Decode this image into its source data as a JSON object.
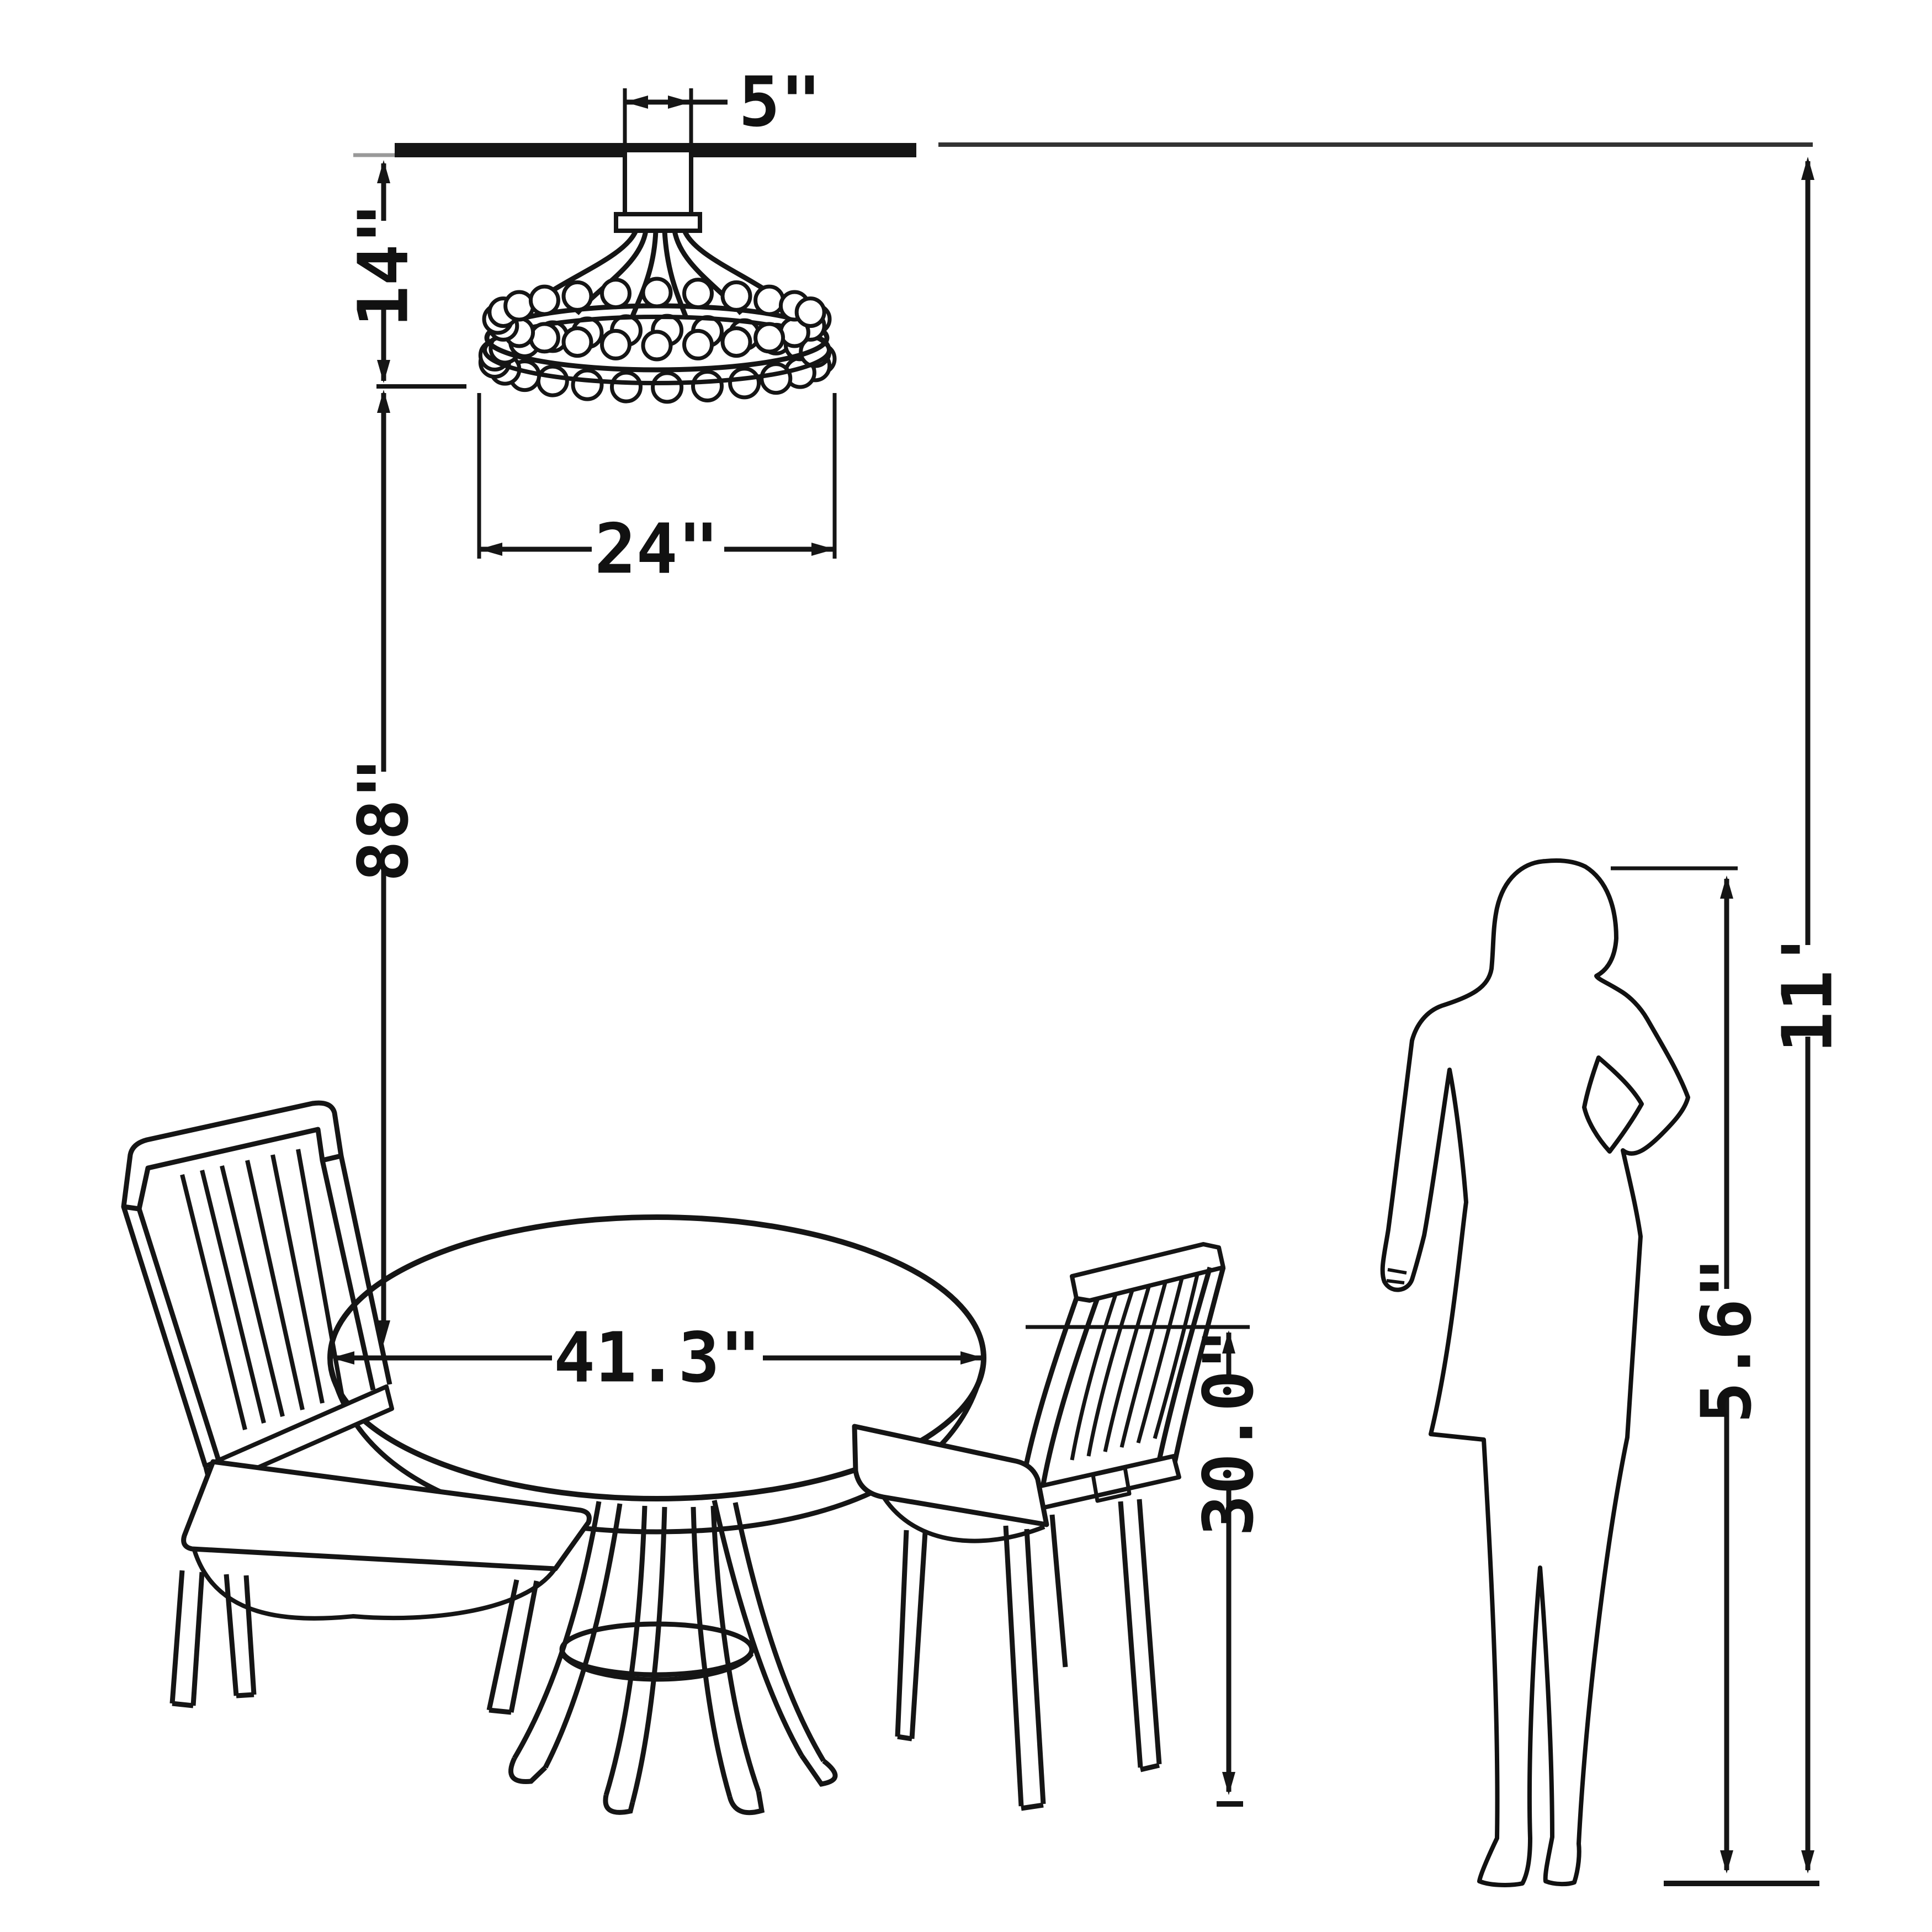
{
  "labels": {
    "canopy_width": "5\"",
    "hanging_height": "14\"",
    "chandelier_diameter": "24\"",
    "chandelier_to_tabletop": "88\"",
    "table_diameter": "41.3\"",
    "table_height": "30.0\"",
    "person_height": "5.6\"",
    "ceiling_height": "11'"
  },
  "colors": {
    "ink": "#151515",
    "thin_ink": "#333333",
    "background": "#ffffff"
  }
}
